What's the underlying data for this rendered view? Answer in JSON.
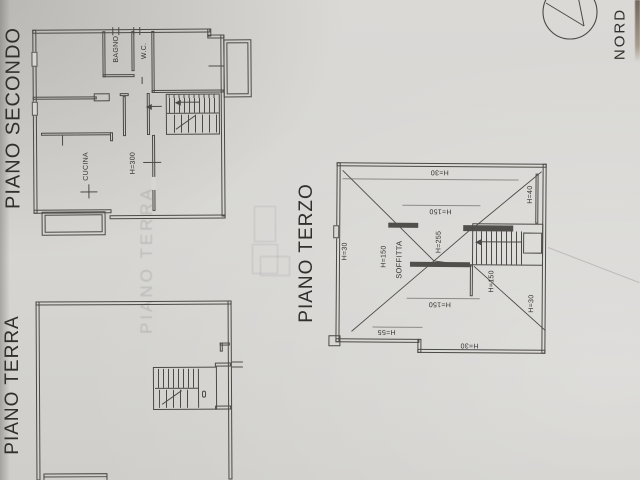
{
  "colors": {
    "paper": "#d6d5d2",
    "line": "#4b4a46",
    "ink": "#2f2e2c"
  },
  "titles": {
    "secondo": "PIANO SECONDO",
    "terra": "PIANO TERRA",
    "terzo": "PIANO TERZO",
    "compass": "NORD"
  },
  "watermark": {
    "text": "PIANO TERRA"
  },
  "plans": {
    "secondo": {
      "labels": {
        "bagno": "BAGNO",
        "wc": "W.C.",
        "cucina": "CUCINA",
        "h300": "H=300"
      }
    },
    "terzo": {
      "labels": {
        "top_h30": "H=30",
        "right_h40": "H=40",
        "upper_h150": "H=150",
        "left_h30": "H=30",
        "left_h150": "H=150",
        "soffitta": "SOFFITTA",
        "h255": "H=255",
        "stair_h150": "H=150",
        "right_h30": "H=30",
        "lower_h150": "H=150",
        "h55": "H=55",
        "bottom_h30": "H=30"
      }
    }
  }
}
